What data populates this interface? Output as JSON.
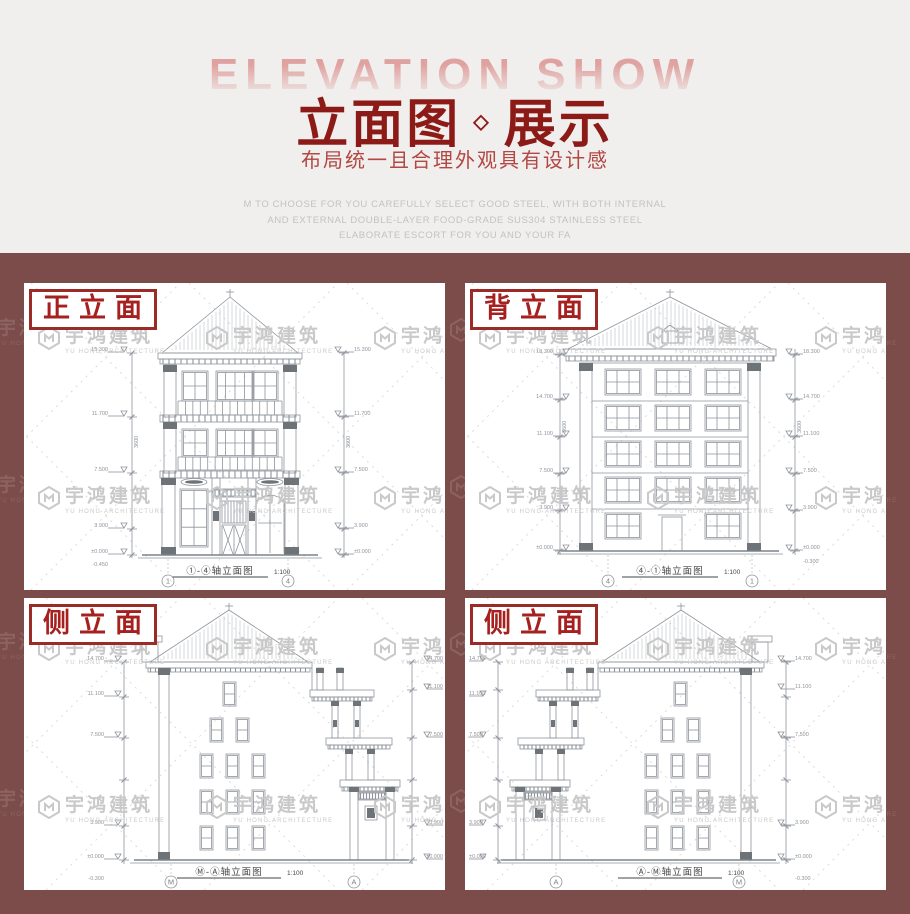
{
  "header": {
    "bg_text": "ELEVATION SHOW",
    "title_left": "立面图",
    "title_diamond": "◇",
    "title_right": "展示",
    "subtitle": "布局统一且合理外观具有设计感",
    "desc_line1": "M TO CHOOSE FOR YOU CAREFULLY SELECT GOOD STEEL, WITH BOTH INTERNAL",
    "desc_line2": "AND EXTERNAL DOUBLE-LAYER FOOD-GRADE SUS304 STAINLESS STEEL",
    "desc_line3": "ELABORATE ESCORT FOR YOU AND YOUR FA"
  },
  "watermark": {
    "name": "宇鸿建筑",
    "subtext": "YU HONG ARCHITECTURE"
  },
  "colors": {
    "section_bg": "#7b4c49",
    "title_red": "#8c1b18",
    "subtitle_red": "#b24743",
    "label_red": "#a5201e",
    "bg_text_pink": "#dfa2a0",
    "drawing_line": "#8e949b"
  },
  "panels": [
    {
      "label": "正立面",
      "caption": "①-④轴立面图",
      "scale": "1:100",
      "axis_left": "1",
      "axis_right": "4",
      "floor_dim": "3600",
      "levels": [
        "15.300",
        "11.700",
        "7.500",
        "3.900",
        "±0.000"
      ],
      "base_level": "-0.450"
    },
    {
      "label": "背立面",
      "caption": "④-①轴立面图",
      "scale": "1:100",
      "axis_left": "4",
      "axis_right": "1",
      "floor_dim": "3600",
      "levels": [
        "18.300",
        "14.700",
        "11.100",
        "7.500",
        "3.900",
        "±0.000"
      ],
      "base_level": "-0.300"
    },
    {
      "label": "侧立面",
      "caption": "Ⓜ-Ⓐ轴立面图",
      "scale": "1:100",
      "axis_left": "M",
      "axis_right": "A",
      "floor_dim": "3600",
      "levels": [
        "14.700",
        "11.100",
        "7.500",
        "3.900",
        "±0.000"
      ],
      "base_level": "-0.300"
    },
    {
      "label": "侧立面",
      "caption": "Ⓐ-Ⓜ轴立面图",
      "scale": "1:100",
      "axis_left": "A",
      "axis_right": "M",
      "floor_dim": "3600",
      "levels": [
        "14.700",
        "11.100",
        "7.500",
        "3.900",
        "±0.000"
      ],
      "base_level": "-0.300"
    }
  ]
}
